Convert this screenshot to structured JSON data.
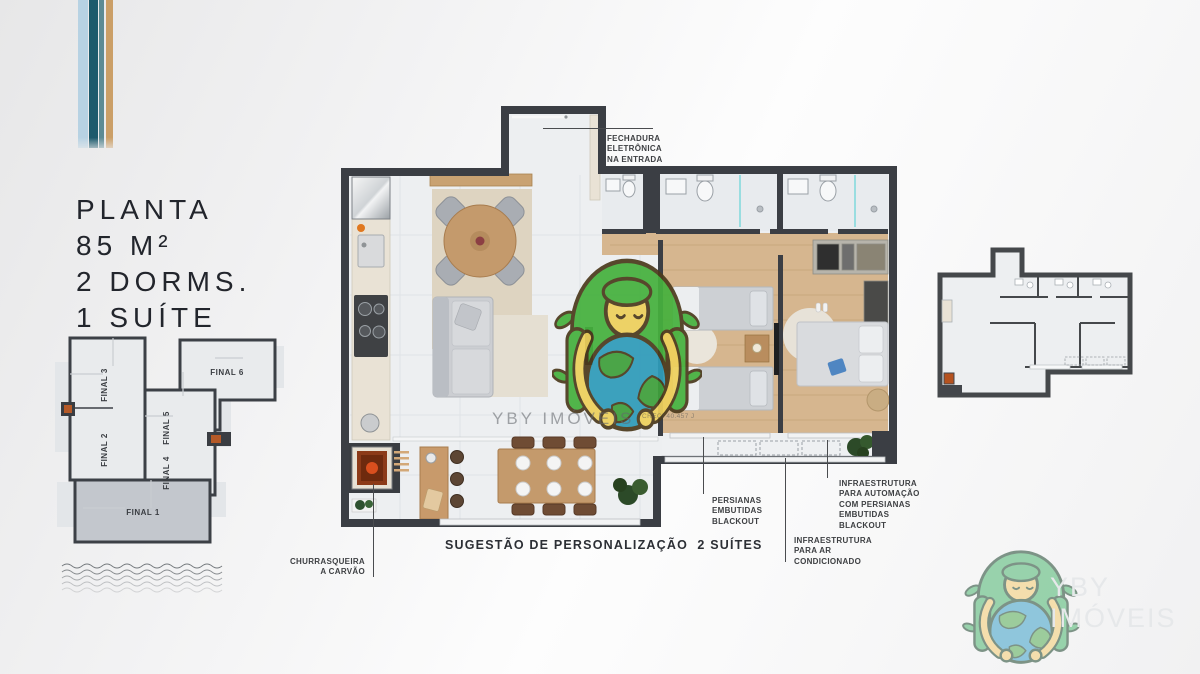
{
  "brand": {
    "name": "YBY IMÓVEIS",
    "watermark_text": "YBY IMÓVEIS",
    "creci": "CRECI 40.457 J"
  },
  "title_block": {
    "lines": [
      "PLANTA",
      "85 M²",
      "2 DORMS.",
      "1 SUÍTE"
    ]
  },
  "key_plan": {
    "highlighted_unit": "FINAL 1",
    "units": [
      "FINAL 1",
      "FINAL 2",
      "FINAL 3",
      "FINAL 4",
      "FINAL 5",
      "FINAL 6"
    ]
  },
  "annotations": {
    "entrance_lock": "FECHADURA\nELETRÔNICA\nNA ENTRADA",
    "blackout_blinds": "PERSIANAS\nEMBUTIDAS\nBLACKOUT",
    "automation": "INFRAESTRUTURA\nPARA AUTOMAÇÃO\nCOM PERSIANAS\nEMBUTIDAS\nBLACKOUT",
    "air_conditioning": "INFRAESTRUTURA\nPARA AR\nCONDICIONADO",
    "barbecue": "CHURRASQUEIRA\nA CARVÃO"
  },
  "caption": "SUGESTÃO DE PERSONALIZAÇÃO  2 SUÍTES",
  "colors": {
    "stripe_light_blue": "#b7d2e3",
    "stripe_dark_teal": "#1d5a6c",
    "stripe_teal": "#5d8b94",
    "stripe_tan": "#cb9f67",
    "wall": "#3b3e44",
    "floor_tile": "#edeff1",
    "wood_floor": "#d6b68f",
    "accent_orange": "#b5521f",
    "mascot_green": "#46b13e",
    "globe_blue": "#2f9cba"
  }
}
